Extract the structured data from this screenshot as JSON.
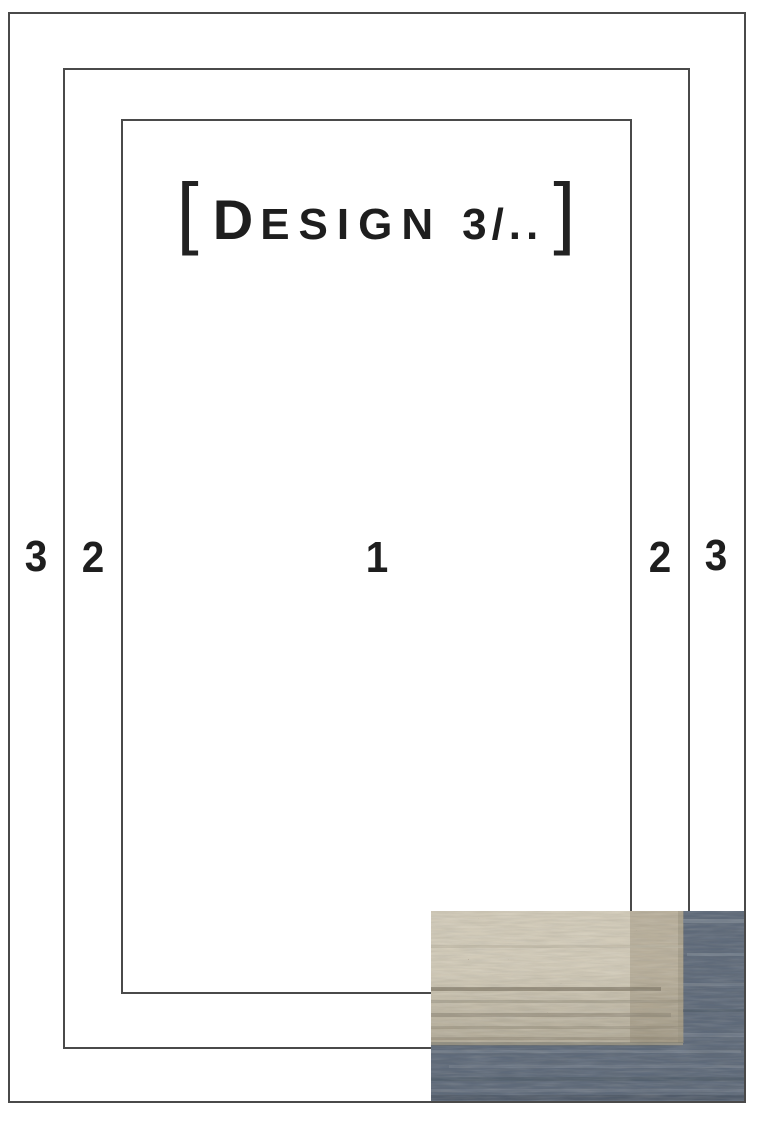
{
  "diagram": {
    "title": {
      "full_text": "[ Design 3/.. ]",
      "bracket_left": "[",
      "initial": "D",
      "small_caps": "ESIGN",
      "number": "3/..",
      "bracket_right": "]"
    },
    "zone_labels": {
      "left_outer": "3",
      "left_inner": "2",
      "center": "1",
      "right_inner": "2",
      "right_outer": "3"
    },
    "colors": {
      "line": "#4a4a4a",
      "text": "#1e1e1e",
      "background": "#ffffff"
    }
  },
  "swatch": {
    "name": "rug-corner-texture-sample",
    "colors": {
      "field_beige": "#d2cbb9",
      "band_beige": "#b9b09c",
      "weft_gray_beige": "#a59d8b",
      "border_blue": "#5d6979"
    }
  }
}
